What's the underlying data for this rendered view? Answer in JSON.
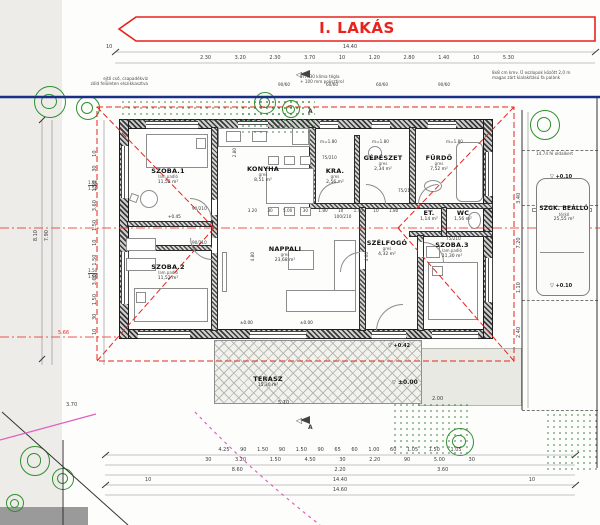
{
  "title": "I. LAKÁS",
  "rooms": [
    {
      "name": "SZOBA.1",
      "floor": "lam.padló",
      "area": "11,52 m²"
    },
    {
      "name": "KONYHA",
      "floor": "gres",
      "area": "8,51 m²"
    },
    {
      "name": "KRA.",
      "floor": "gres",
      "area": "2,56 m²"
    },
    {
      "name": "GÉPÉSZET",
      "floor": "gres",
      "area": "2,34 m²"
    },
    {
      "name": "FÜRDŐ",
      "floor": "gres",
      "area": "7,52 m²"
    },
    {
      "name": "ET.",
      "floor": "gres",
      "area": "1,14 m²"
    },
    {
      "name": "WC",
      "floor": "gres",
      "area": "1,56 m²"
    },
    {
      "name": "SZOBA.2",
      "floor": "lam.padló",
      "area": "11,52 m²"
    },
    {
      "name": "NAPPALI",
      "floor": "gres",
      "area": "23,68 m²"
    },
    {
      "name": "SZÉLFOGÓ",
      "floor": "gres",
      "area": "4,32 m²"
    },
    {
      "name": "SZOBA.3",
      "floor": "lam.padló",
      "area": "11,30 m²"
    },
    {
      "name": "TERASZ",
      "floor": "",
      "area": "15,30 m²"
    },
    {
      "name": "SZGK. BEÁLLÓ",
      "floor": "térkő",
      "area": "25,55 m²"
    }
  ],
  "notes": {
    "downpipe1": "ejtő cső, csapadékvíz",
    "downpipe2": "zöld felületen elszikkasztva",
    "wall1": "PTH 30 klíma tégla",
    "wall2": "+ 100 mm polisztirol",
    "fence1": "8x8 cm kmv. Ü oszlopok között 2,0 m",
    "fence2": "magas zárt kialakítású fa palánk",
    "side": "14,74 fé oldalkert"
  },
  "levels": {
    "entry": "±0.00",
    "terrace": "+0.42",
    "parking1": "+0.10",
    "parking2": "+0.10",
    "nappali1": "±0.00",
    "nappali2": "±0.00",
    "room1": "+0.45"
  },
  "heights": {
    "h1": "m=1.80",
    "h2": "m=1.80",
    "h3": "m=1.80"
  },
  "openings": {
    "w1": "90/60",
    "w2": "60/60",
    "w3": "60/60",
    "w4": "90/60",
    "wl1a": "1.50",
    "wl1b": "1.50",
    "wl2a": "1.50",
    "wl2b": "1.50",
    "d1": "90/210",
    "d2": "90/210",
    "d3": "75/210",
    "d4": "100/210",
    "d5": "75/210",
    "d6": "75/210"
  },
  "dims": {
    "top_total": "14.40",
    "top_10l": "10",
    "top_row": "2.30 3.20 2.30 3.70 10 1.20 2.80 1.40 10 5.30",
    "mid_row": "3.20 30 5.00 30 1.80 10 1.40 10 1.80",
    "bottom_row1": "4.25 90 1.50 90 1.50 90 65 60 1.00 60 1.05 1.50 1.05",
    "bottom_row2": "30 3.20 1.50 4.50 30 2.20 90 5.00 30",
    "bottom_row3": "8.60 2.20 3.60",
    "bottom_row4": "10 14.40 10",
    "bottom_row5": "14.60",
    "left_chain": "10 30 1.50 3.60 1.50 10 1.50 3.60 1.50 30 10",
    "left_total1": "7.90",
    "left_total2": "8.10",
    "right_chain": "2.40 1.10 7.20 3.40",
    "nappali_h": "4.80",
    "szelfogo_h": "4.60",
    "konyha_h": "2.80",
    "terrace_w": "5.10",
    "terrace_s": "2.00",
    "left_b": "3.70",
    "red_dim": "5.66"
  },
  "section": {
    "label_top": "A",
    "label_bottom": "A"
  },
  "icons": {
    "level_marker": "▽",
    "section_marker": "◁"
  },
  "colors": {
    "accent_red": "#e8221c",
    "boundary_blue": "#1a2f86",
    "tree_green": "#2f8f2f",
    "magenta": "#e060c0",
    "dim_grey": "#5a5a5a"
  }
}
